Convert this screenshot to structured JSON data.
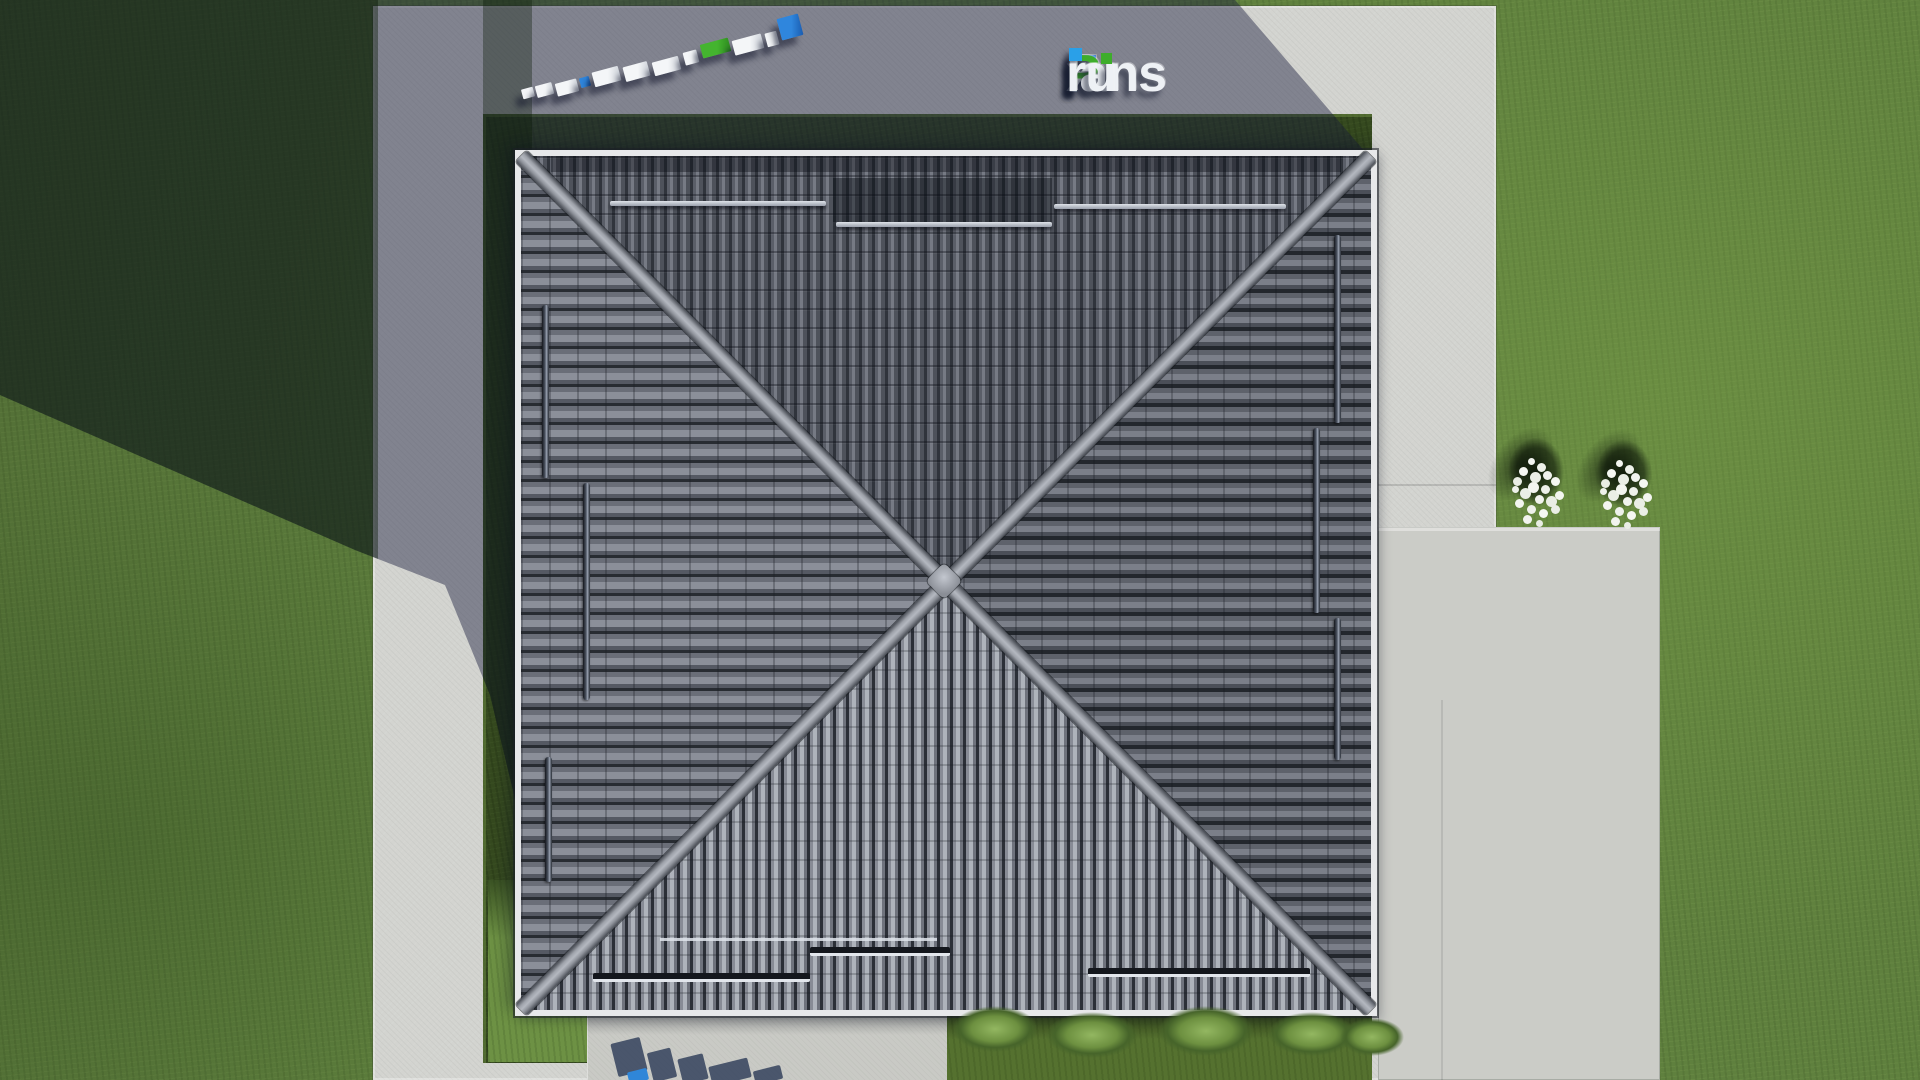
{
  "watermark": {
    "text": "FixPlans.ru",
    "segments": {
      "f": "F",
      "i_glyph": "ı",
      "x": "x",
      "p": "P",
      "lans": "lans",
      "dot": ".",
      "ru": "ru"
    },
    "colors": {
      "f": "#1a6fd6",
      "p": "#3ead2b",
      "letters": "#eef1f5",
      "dot_square": "#2aa0e8",
      "i_dot": "#3ead2b"
    }
  },
  "ground_text_blocks": {
    "represents": "FixPlans.ru",
    "block_count": 12,
    "colors": {
      "letter_block": "#eef0f3",
      "f_block": "#2f86dd",
      "p_block": "#44b42f",
      "dot_block": "#2f86dd"
    }
  },
  "scene": {
    "type": "aerial-3d-render-top-view",
    "house_roof": {
      "style": "hipped square roof, gray tiles",
      "ridges": 4,
      "snow_guard_bars": {
        "north_slope": 3,
        "south_slope": 3,
        "west_slope": 3,
        "east_slope": 3
      }
    },
    "trees_with_white_flowers": 2,
    "bushes_along_south_edge": 5,
    "palette": {
      "grass_lit": "#5f803e",
      "grass_shadow": "#33491f",
      "concrete_lit": "#d3d4d0",
      "concrete_shadow": "#8f8e9f",
      "roof_tile_dark": "#30343c",
      "roof_tile_light": "#aeb3bb",
      "ridge": "#9ea2aa",
      "fascia": "#e7e8ea"
    }
  }
}
